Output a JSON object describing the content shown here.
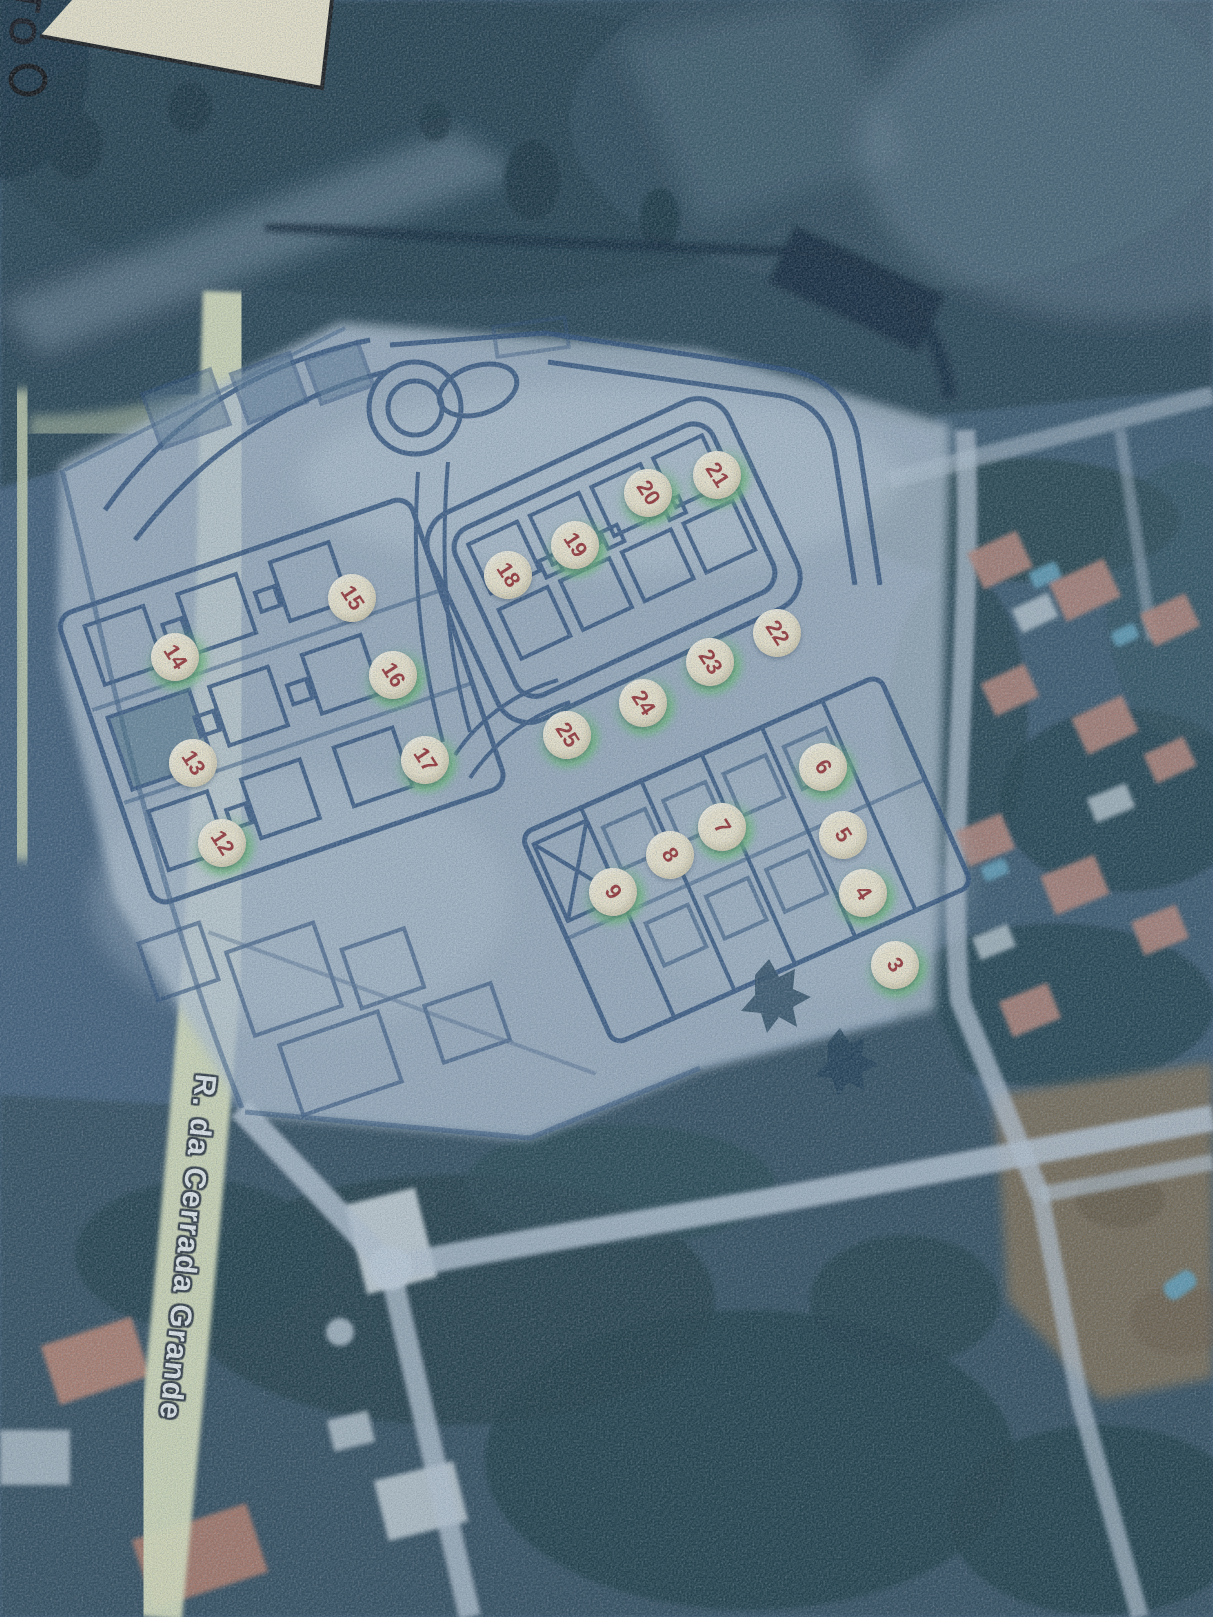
{
  "scene": {
    "type": "printed-aerial-site-plan-photo",
    "street_label": "R. da Cerrada Grande",
    "corner_label": "TO",
    "marker_style": {
      "fill": "#f2e9cf",
      "number_color": "#9c3434",
      "glow_color": "#6ebe78",
      "number_rotation_deg": 57
    },
    "colors": {
      "plan_line": "#2c4e78",
      "plan_fill": "#b6c5d1",
      "road_yellow": "#dde2bd",
      "satellite_dark": "#2b4453",
      "vegetation": "#22404a",
      "roof": "#b58579",
      "pool": "#62a0b8",
      "road_light": "#b9c6d2"
    },
    "markers": [
      {
        "label": "3",
        "x": 895,
        "y": 965,
        "glow": true
      },
      {
        "label": "4",
        "x": 863,
        "y": 893,
        "glow": true
      },
      {
        "label": "5",
        "x": 843,
        "y": 835,
        "glow": false
      },
      {
        "label": "6",
        "x": 823,
        "y": 767,
        "glow": true
      },
      {
        "label": "7",
        "x": 722,
        "y": 827,
        "glow": true
      },
      {
        "label": "8",
        "x": 670,
        "y": 855,
        "glow": false
      },
      {
        "label": "9",
        "x": 613,
        "y": 892,
        "glow": true
      },
      {
        "label": "12",
        "x": 222,
        "y": 843,
        "glow": true
      },
      {
        "label": "13",
        "x": 193,
        "y": 763,
        "glow": false
      },
      {
        "label": "14",
        "x": 175,
        "y": 657,
        "glow": true
      },
      {
        "label": "15",
        "x": 352,
        "y": 598,
        "glow": false
      },
      {
        "label": "16",
        "x": 393,
        "y": 675,
        "glow": true
      },
      {
        "label": "17",
        "x": 425,
        "y": 760,
        "glow": true
      },
      {
        "label": "18",
        "x": 508,
        "y": 575,
        "glow": false
      },
      {
        "label": "19",
        "x": 575,
        "y": 545,
        "glow": true
      },
      {
        "label": "20",
        "x": 648,
        "y": 493,
        "glow": true
      },
      {
        "label": "21",
        "x": 717,
        "y": 475,
        "glow": true
      },
      {
        "label": "22",
        "x": 777,
        "y": 633,
        "glow": false
      },
      {
        "label": "23",
        "x": 710,
        "y": 662,
        "glow": true
      },
      {
        "label": "24",
        "x": 643,
        "y": 703,
        "glow": true
      },
      {
        "label": "25",
        "x": 567,
        "y": 735,
        "glow": true
      }
    ]
  }
}
